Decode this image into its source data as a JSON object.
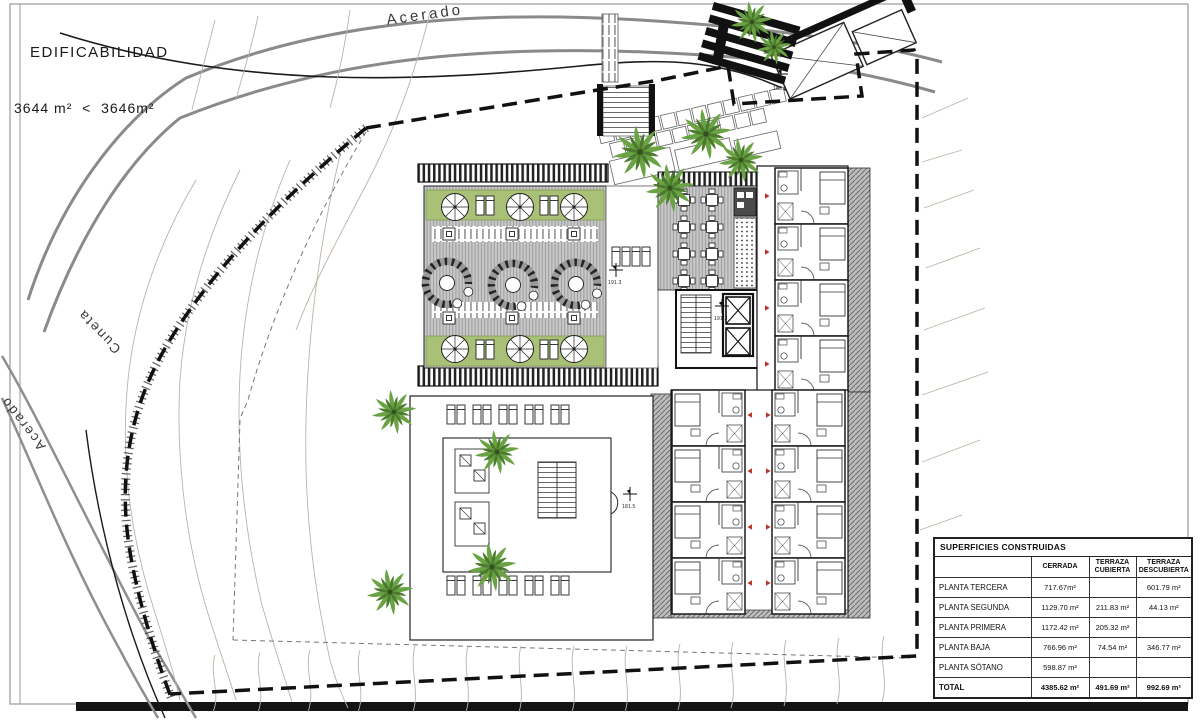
{
  "annotations": {
    "edificability": {
      "title": "EDIFICABILIDAD",
      "comparison": "3644 m²  <  3646m²"
    },
    "streets": {
      "top": "Acerado",
      "left_upper": "Cuneta",
      "left_lower": "Acerado"
    },
    "levels": {
      "roof_terrace": "191.3",
      "core": "191.3",
      "pool_deck": "181.5",
      "entrance": "183.5"
    }
  },
  "table": {
    "title": "SUPERFICIES CONSTRUIDAS",
    "headers": [
      "CERRADA",
      "TERRAZA CUBIERTA",
      "TERRAZA DESCUBIERTA"
    ],
    "rows": [
      {
        "label": "PLANTA TERCERA",
        "cerrada": "717.67m²",
        "cubierta": "",
        "descubierta": "601.79 m²"
      },
      {
        "label": "PLANTA SEGUNDA",
        "cerrada": "1129.70 m²",
        "cubierta": "211.83 m²",
        "descubierta": "44.13 m²"
      },
      {
        "label": "PLANTA PRIMERA",
        "cerrada": "1172.42 m²",
        "cubierta": "205.32 m²",
        "descubierta": ""
      },
      {
        "label": "PLANTA BAJA",
        "cerrada": "766.96 m²",
        "cubierta": "74.54 m²",
        "descubierta": "346.77 m²"
      },
      {
        "label": "PLANTA SÓTANO",
        "cerrada": "598.87 m²",
        "cubierta": "",
        "descubierta": ""
      },
      {
        "label": "TOTAL",
        "cerrada": "4385.62 m²",
        "cubierta": "491.69 m²",
        "descubierta": "992.69 m²"
      }
    ]
  },
  "colors": {
    "planting_green": "#a9c177",
    "deck_gray": "#c9c9c9",
    "contour_tan": "#bdb2a4",
    "boundary_black": "#111111",
    "door_marker_red": "#b7352c",
    "tree_light": "#6aa344",
    "tree_dark": "#4c7b2e"
  }
}
